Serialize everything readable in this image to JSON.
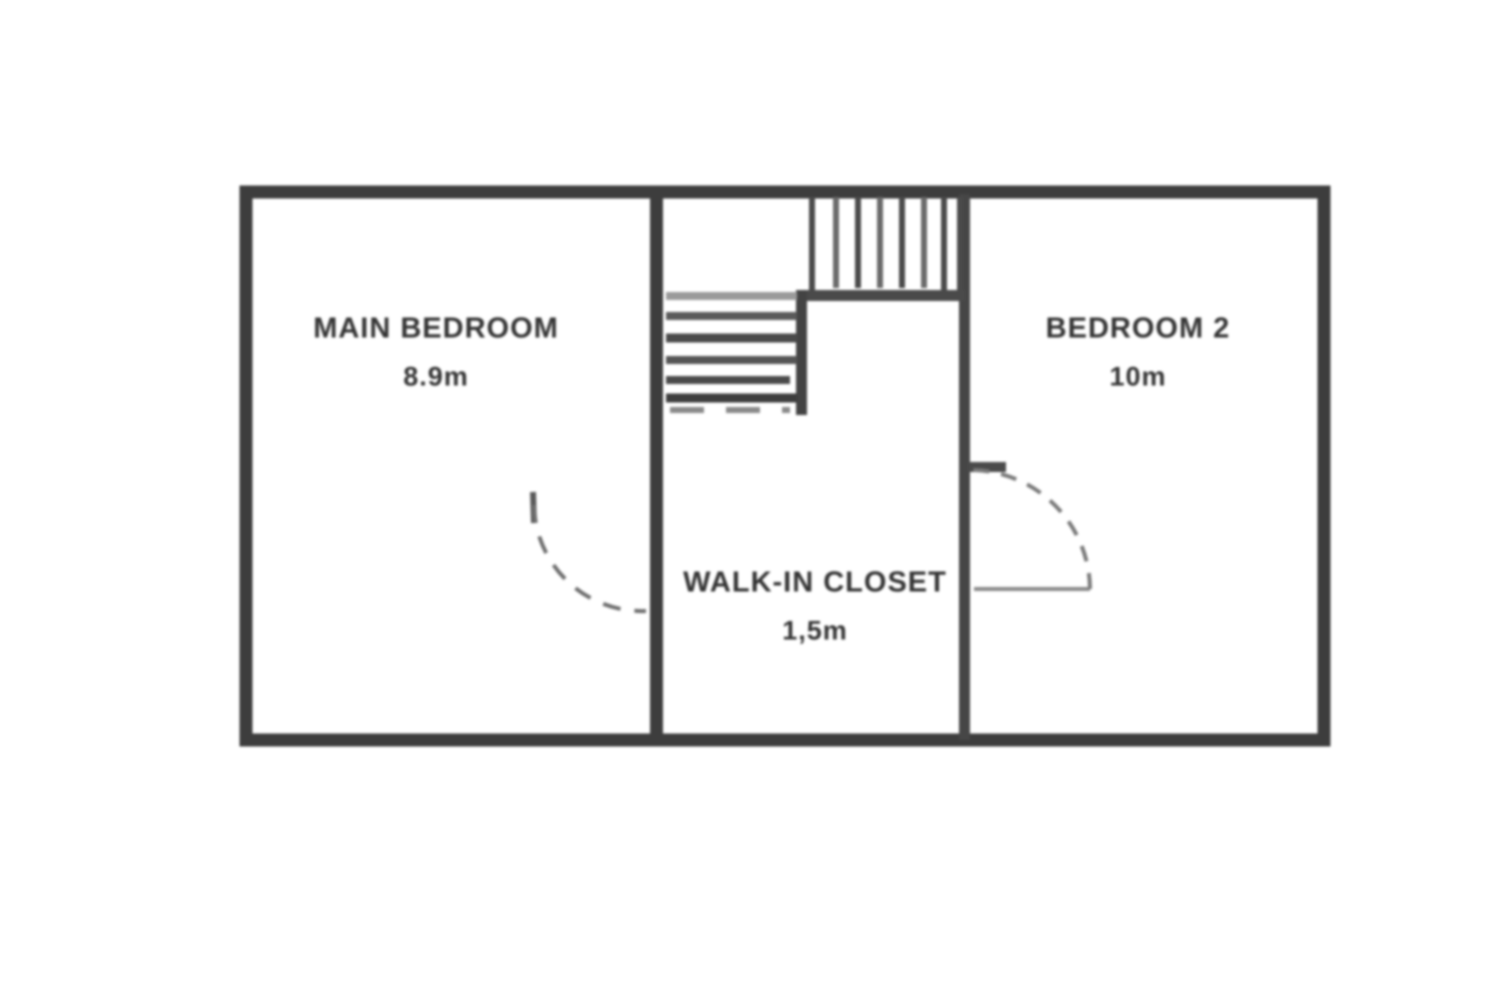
{
  "plan_title": "First floor plan",
  "rooms": {
    "left": {
      "name": "MAIN BEDROOM",
      "area": "8.9m"
    },
    "middle": {
      "name": "WALK-IN CLOSET",
      "area": "1,5m"
    },
    "right": {
      "name": "BEDROOM 2",
      "area": "10m"
    }
  },
  "colors": {
    "wall": "#3d3d3d",
    "stair_line": "#4a4a4a",
    "light_line": "#8a8a8a",
    "background": "#ffffff",
    "text": "#343434"
  }
}
